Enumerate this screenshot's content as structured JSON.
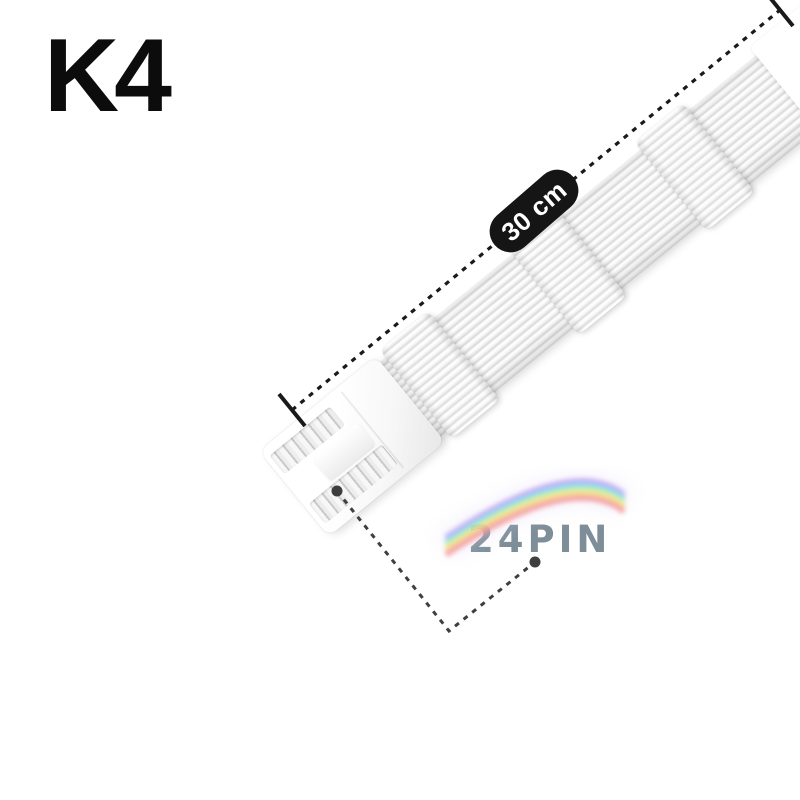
{
  "labels": {
    "variant": "K4",
    "length": "30 cm",
    "pin_count": "24PIN"
  },
  "colors": {
    "background": "#ffffff",
    "variant_text": "#0c0c0c",
    "dimension_line": "#1a1a1a",
    "badge_bg": "#151515",
    "badge_text": "#ffffff",
    "pin_count_text": "#7d8e99",
    "leader_gray": "#3f3f3f",
    "cable_white": "#fbfbfb",
    "cable_groove": "#d6d7d7"
  },
  "rainbow": {
    "colors": [
      "#c9a0f0",
      "#8fb8f5",
      "#86e0e8",
      "#b2ee8e",
      "#f7ea86",
      "#f7bc84",
      "#f49a9f"
    ],
    "glow": "#ddd2f2"
  }
}
